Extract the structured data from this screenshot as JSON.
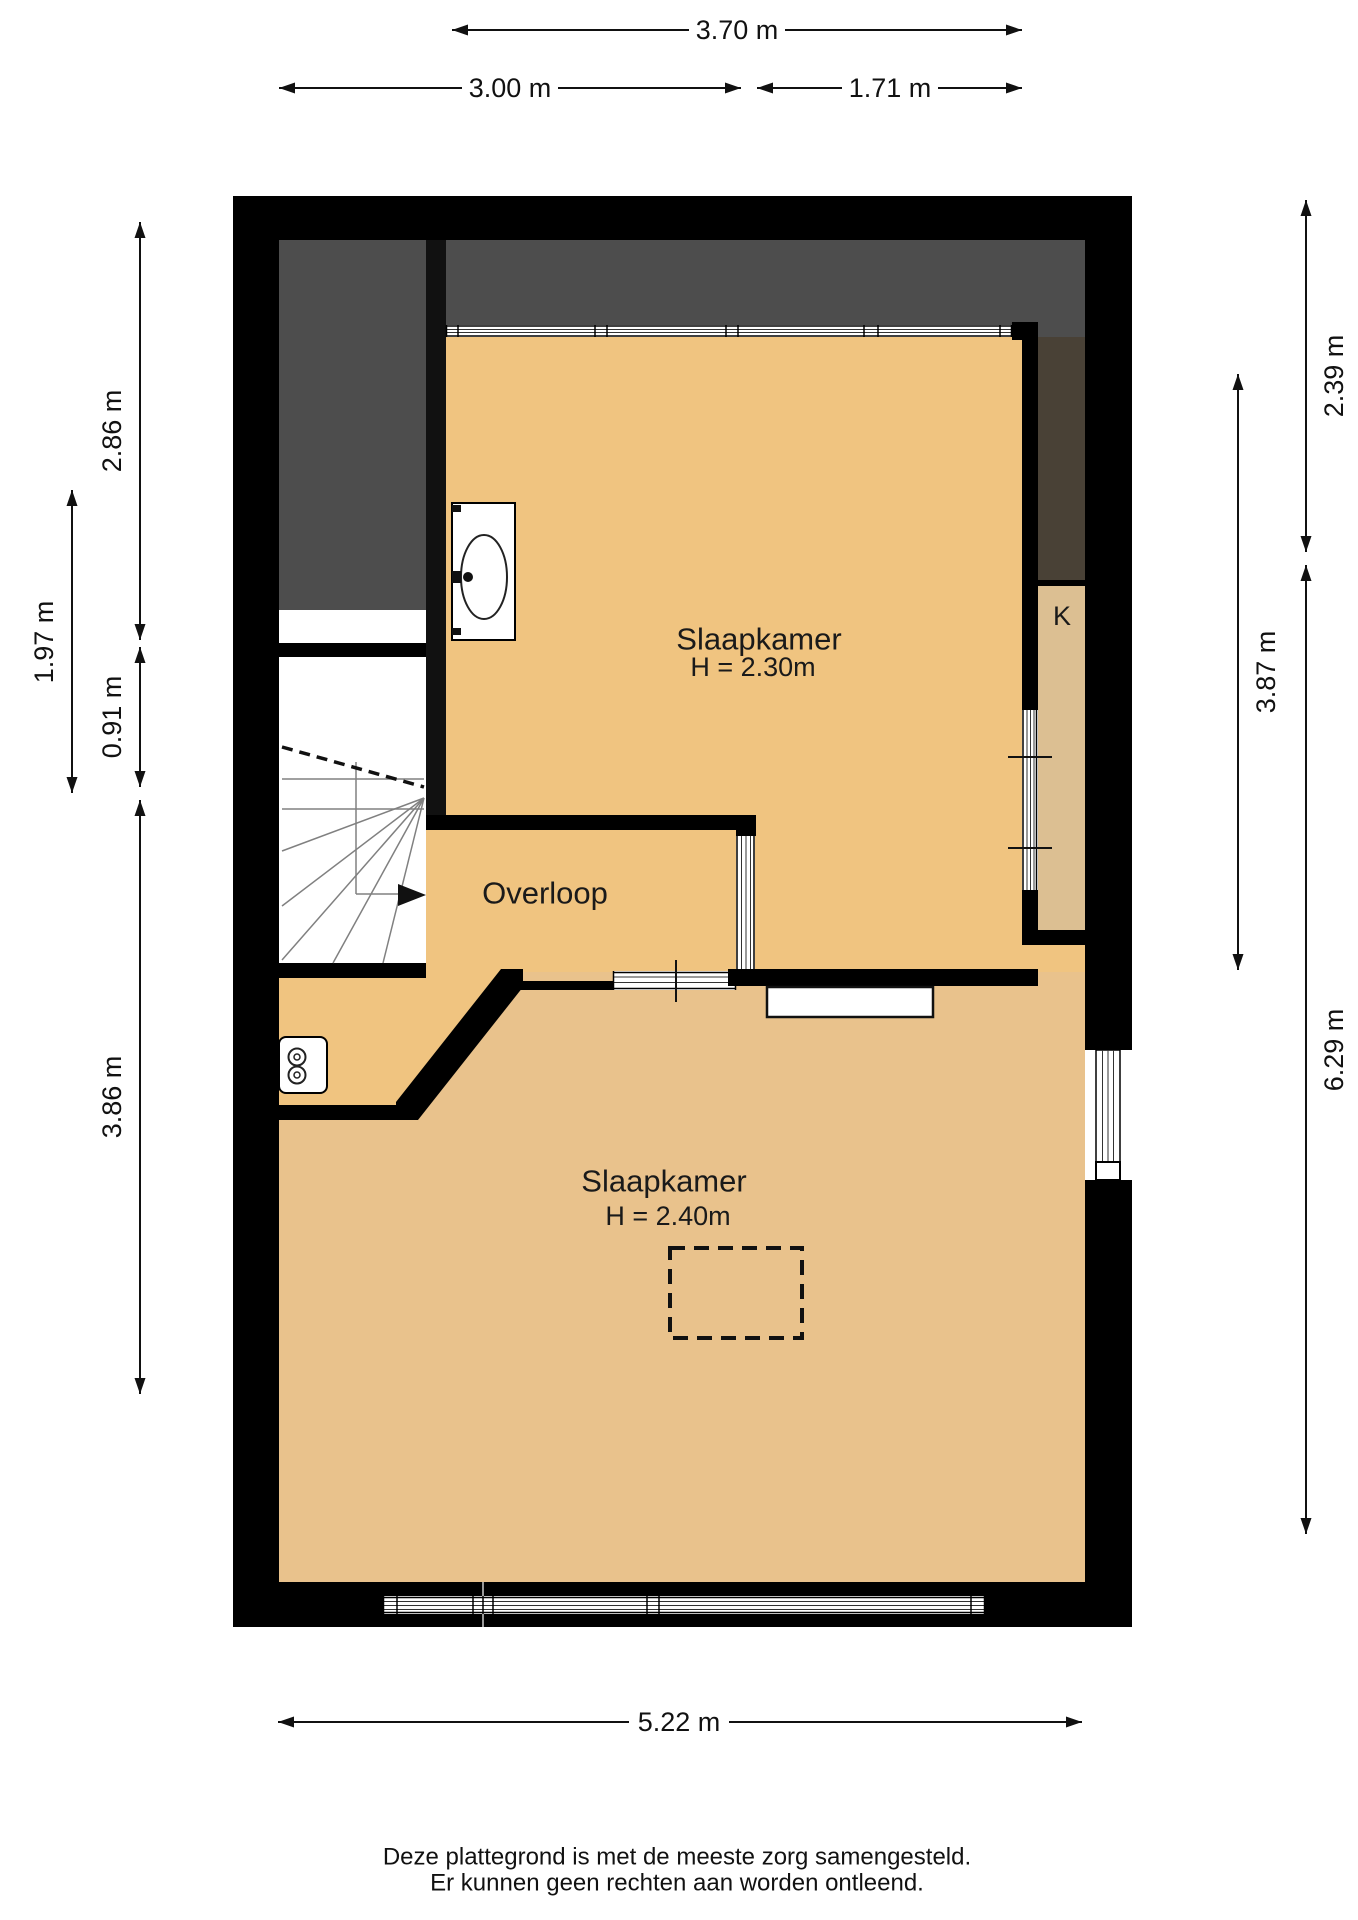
{
  "colors": {
    "wall": "#000000",
    "floor_main": "#f0c480",
    "floor_lower": "#e9c28c",
    "closet_floor": "#dcbf92",
    "roof_shadow": "#4d4d4d",
    "roof_shadow_dark": "#494136",
    "background": "#ffffff"
  },
  "rooms": {
    "bedroom_top": {
      "name": "Slaapkamer",
      "height": "H = 2.30m"
    },
    "landing": {
      "name": "Overloop"
    },
    "bedroom_bottom": {
      "name": "Slaapkamer",
      "height": "H = 2.40m"
    },
    "closet": {
      "name": "K"
    }
  },
  "dimensions": {
    "top_total": "3.70 m",
    "top_left": "3.00 m",
    "top_right": "1.71 m",
    "left_upper": "2.86 m",
    "left_outer": "1.97 m",
    "left_middle": "0.91 m",
    "left_lower": "3.86 m",
    "right_upper": "2.39 m",
    "right_middle": "3.87 m",
    "right_lower": "6.29 m",
    "bottom": "5.22 m"
  },
  "footer": {
    "line1": "Deze plattegrond is met de meeste zorg samengesteld.",
    "line2": "Er kunnen geen rechten aan worden ontleend."
  }
}
